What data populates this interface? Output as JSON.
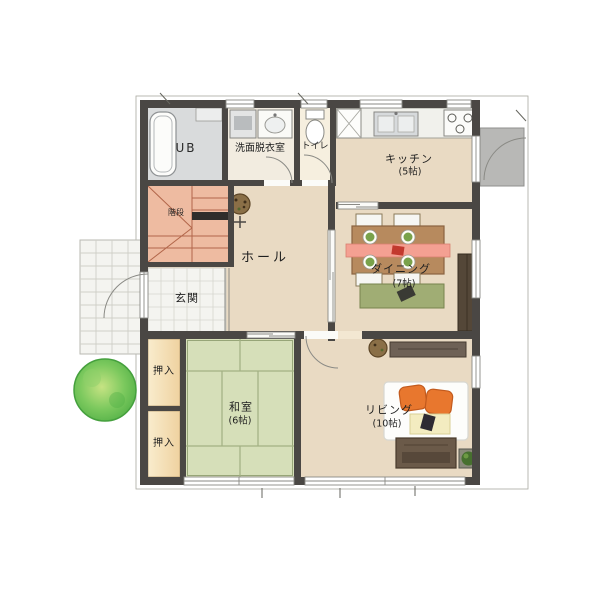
{
  "rooms": {
    "ub": {
      "label": "UB"
    },
    "washroom": {
      "label": "洗面脱衣室"
    },
    "toilet": {
      "label": "トイレ"
    },
    "kitchen": {
      "label": "キッチン",
      "size": "(5帖)"
    },
    "hall": {
      "label": "ホール"
    },
    "stairs": {
      "label": "階段"
    },
    "genkan": {
      "label": "玄関"
    },
    "dining": {
      "label": "ダイニング",
      "size": "(7帖)"
    },
    "washitsu": {
      "label": "和室",
      "size": "(6帖)"
    },
    "living": {
      "label": "リビング",
      "size": "(10帖)"
    },
    "oshiire_upper": {
      "label": "押入"
    },
    "oshiire_lower": {
      "label": "押入"
    }
  },
  "colors": {
    "wall": "#4a4744",
    "floor": "#e9dac3",
    "tatami": "#d6dfb9",
    "closet": "#f6e2ba",
    "stairs": "#eebba1",
    "bath": "#d9dbdc",
    "washroom": "#f2ece0",
    "toilet_room": "#f6efdf",
    "tile": "#f4f4f0",
    "landing": "#b8b8b6",
    "tree": "#5cb54c",
    "cushion": "#e8772e",
    "dining_rug": "#a0ad74",
    "table": "#b78a5e",
    "runner": "#f4a092",
    "tv_board": "#6b5a49"
  }
}
